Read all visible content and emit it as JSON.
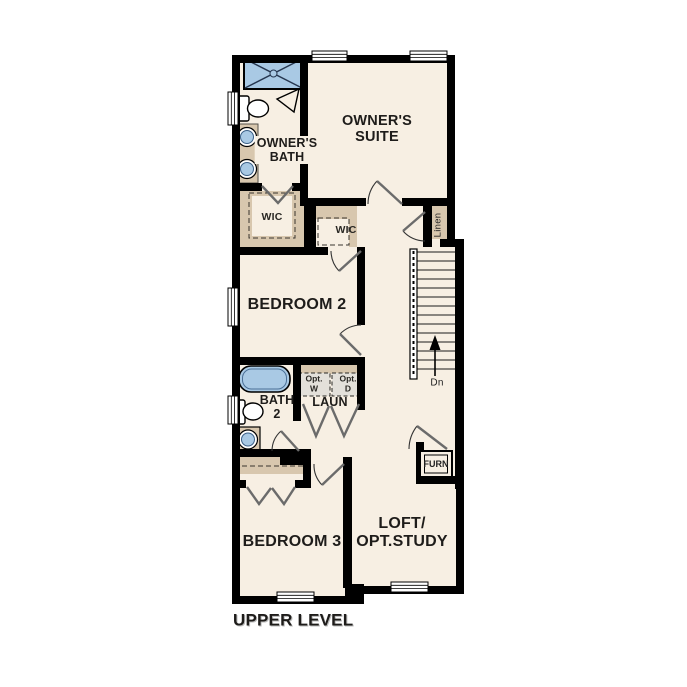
{
  "title": "UPPER LEVEL",
  "colors": {
    "wall": "#000000",
    "floor": "#f7efe3",
    "fixture_blue": "#a9c9e4",
    "casework_tan": "#d8c7ae",
    "opt_box_gray": "#e3e0da",
    "text": "#1e1c1a"
  },
  "rooms": {
    "owners_suite": {
      "line1": "OWNER'S",
      "line2": "SUITE"
    },
    "owners_bath": {
      "line1": "OWNER'S",
      "line2": "BATH"
    },
    "wic_large": "WIC",
    "wic_small": "WIC",
    "linen": "Linen",
    "bedroom2": "BEDROOM 2",
    "bath2": {
      "line1": "BATH",
      "line2": "2"
    },
    "laundry": "LAUN",
    "opt_washer": {
      "line1": "Opt.",
      "line2": "W"
    },
    "opt_dryer": {
      "line1": "Opt.",
      "line2": "D"
    },
    "bedroom3": "BEDROOM 3",
    "loft": {
      "line1": "LOFT/",
      "line2": "OPT.STUDY"
    },
    "furnace": "FURN",
    "stairs_direction": "Dn"
  }
}
